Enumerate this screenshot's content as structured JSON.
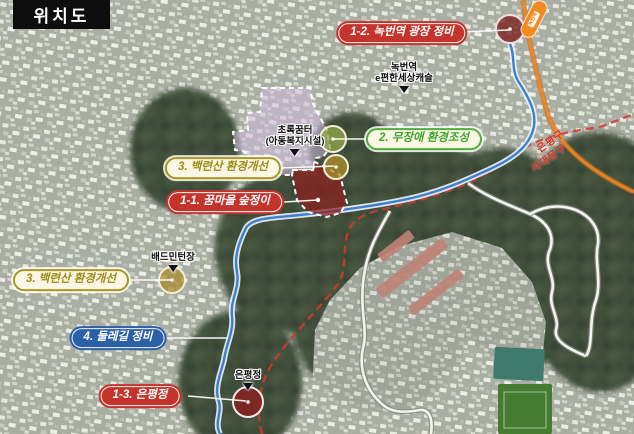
{
  "title": "위치도",
  "callouts": {
    "c12": {
      "label": "1-2. 녹번역 광장 정비"
    },
    "c2": {
      "label": "2. 무장애 환경조성"
    },
    "c3a": {
      "label": "3. 백련산 환경개선"
    },
    "c11": {
      "label": "1-1. 꿈마을 숲정이"
    },
    "c3b": {
      "label": "3. 백련산 환경개선"
    },
    "c4": {
      "label": "4. 둘레길 정비"
    },
    "c13": {
      "label": "1-3. 은평정"
    }
  },
  "poi": {
    "apartment": {
      "line1": "녹번역",
      "line2": "e편한세상캐슬"
    },
    "childcare": {
      "line1": "초록꿈터",
      "line2": "(아동복지시설)"
    },
    "badminton": {
      "line1": "배드민턴장"
    },
    "pavilion": {
      "line1": "은평정"
    }
  },
  "districts": {
    "eunpyeong": "은평구",
    "seodaemun": "서대문구"
  },
  "station": {
    "name": "녹번역"
  },
  "colors": {
    "callout_red": "#c5342c",
    "callout_green": "#4fae3c",
    "callout_olive": "#a89820",
    "callout_blue": "#2c5fa8",
    "district_boundary_red": "#d92f20",
    "stream_blue": "#3a7fd0",
    "road_orange": "#ef8b1f",
    "site_purple": "#cdb9dd",
    "site_red": "#8e1f1f"
  }
}
